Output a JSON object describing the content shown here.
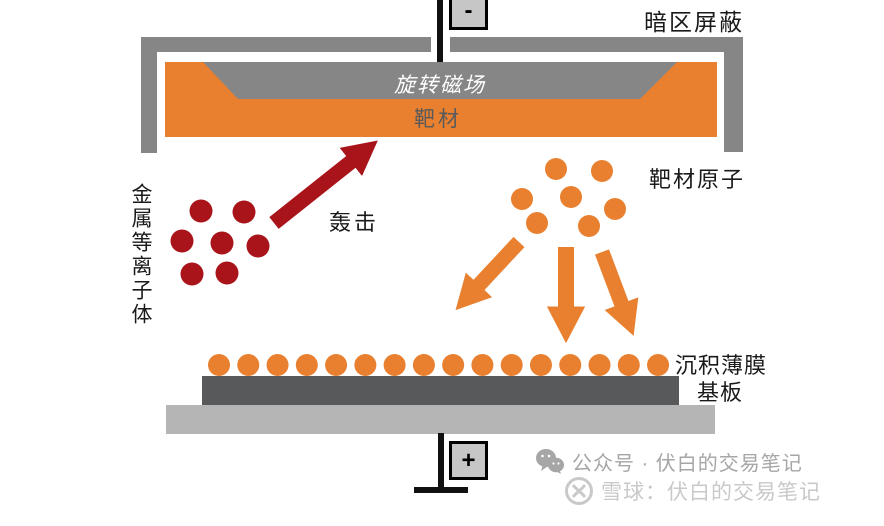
{
  "labels": {
    "dark_area_shield": "暗区屏蔽",
    "rotating_magnetic_field": "旋转磁场",
    "target": "靶材",
    "target_atoms": "靶材原子",
    "metal_plasma": "金属等离子体",
    "bombardment": "轰击",
    "deposited_film": "沉积薄膜",
    "substrate": "基板",
    "negative_electrode": "-",
    "positive_electrode": "+"
  },
  "watermarks": {
    "wechat_label": "公众号 · 伏白的交易笔记",
    "xueqiu_label": "雪球：伏白的交易笔记"
  },
  "colors": {
    "orange": "#E8802F",
    "dark_red": "#A8141A",
    "gray": "#868686",
    "dark_gray": "#58595B",
    "light_gray": "#B5B5B5",
    "black": "#111111",
    "wechat_gray": "#a6a6a6",
    "xueqiu_gray": "#c9c9c9"
  },
  "diagram": {
    "dot_radius": 11.5,
    "plasma_ion_dots": [
      [
        201,
        211
      ],
      [
        244,
        212
      ],
      [
        182,
        241
      ],
      [
        222,
        243
      ],
      [
        258,
        246
      ],
      [
        192,
        274
      ],
      [
        227,
        273
      ]
    ],
    "target_atom_dots": [
      [
        556,
        169
      ],
      [
        602,
        171
      ],
      [
        522,
        199
      ],
      [
        571,
        197
      ],
      [
        615,
        209
      ],
      [
        537,
        223
      ],
      [
        589,
        226
      ]
    ],
    "film_dots": {
      "count": 16,
      "x_start": 219,
      "x_spacing": 29.27,
      "y": 365,
      "rx": 11,
      "ry": 11
    },
    "bombard_arrow": {
      "from": [
        274,
        223
      ],
      "to": [
        352,
        161
      ],
      "width": 15
    },
    "deposit_arrows": [
      {
        "from": [
          519,
          242
        ],
        "to": [
          478,
          286
        ],
        "width": 15
      },
      {
        "from": [
          566,
          247
        ],
        "to": [
          566,
          308
        ],
        "width": 16
      },
      {
        "from": [
          602,
          252
        ],
        "to": [
          622,
          305
        ],
        "width": 15
      }
    ]
  }
}
